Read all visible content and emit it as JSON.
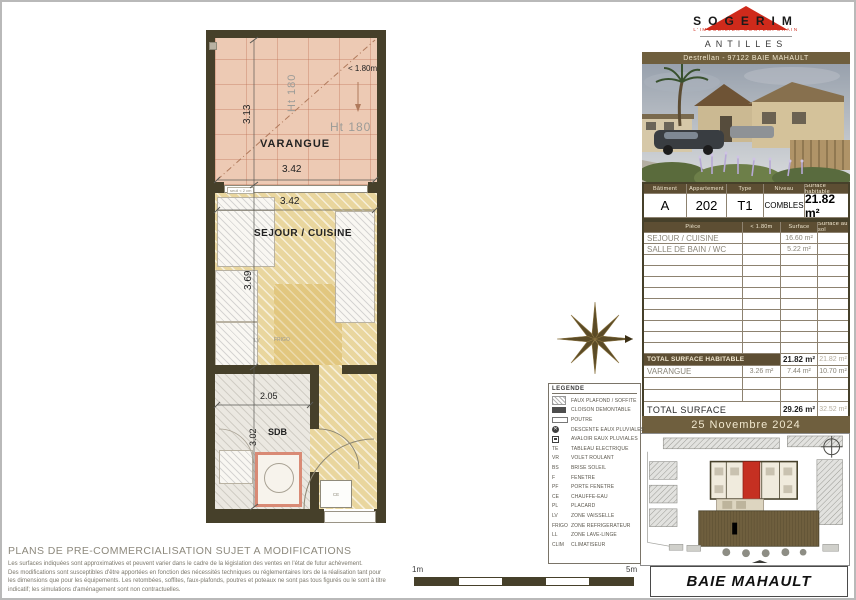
{
  "logo": {
    "company": "SOGERIM",
    "tagline": "L'IMMOBILIER CONTEMPORAIN",
    "region": "ANTILLES",
    "address": "Destrellan - 97122 BAIE MAHAULT"
  },
  "info_table": {
    "headers": [
      "Bâtiment",
      "Appartement",
      "Type",
      "Niveau",
      "Surface habitable"
    ],
    "values": {
      "batiment": "A",
      "appartement": "202",
      "type": "T1",
      "niveau": "COMBLES",
      "surface": "21.82 m²"
    }
  },
  "rooms_table": {
    "headers": [
      "Pièce",
      "< 1.80m",
      "Surface",
      "Surface au sol"
    ],
    "rows": [
      {
        "name": "SEJOUR / CUISINE",
        "lt180": "",
        "surface": "16.60 m²",
        "au_sol": ""
      },
      {
        "name": "SALLE DE BAIN / WC",
        "lt180": "",
        "surface": "5.22 m²",
        "au_sol": ""
      }
    ],
    "total_habitable": {
      "label": "TOTAL SURFACE HABITABLE",
      "surface": "21.82 m²",
      "au_sol": "21.82 m²"
    },
    "varangue_row": {
      "name": "VARANGUE",
      "lt180": "3.26 m²",
      "surface": "7.44 m²",
      "au_sol": "10.70 m²"
    },
    "total": {
      "label": "TOTAL SURFACE",
      "surface": "29.26 m²",
      "au_sol": "32.52 m²"
    }
  },
  "date": "25 Novembre 2024",
  "city": "BAIE MAHAULT",
  "plan": {
    "varangue": {
      "name": "VARANGUE",
      "width": "3.42",
      "height": "3.13",
      "ht1": "Ht 180",
      "ht2": "Ht 180",
      "low": "< 1.80m"
    },
    "sejour": {
      "name": "SEJOUR / CUISINE",
      "width": "3.42",
      "height": "3.69",
      "lv": "LV",
      "frigo": "FRIGO"
    },
    "sdb": {
      "name": "SDB",
      "width": "2.05",
      "height": "3.02",
      "ce": "CE"
    },
    "window_note": "seuil < 2 cm"
  },
  "legend": {
    "title": "LEGENDE",
    "items": [
      {
        "sym": "hatch",
        "label": "FAUX PLAFOND / SOFFITE"
      },
      {
        "sym": "dark",
        "label": "CLOISON DEMONTABLE"
      },
      {
        "sym": "outline",
        "label": "POUTRE"
      },
      {
        "sym": "circle",
        "label": "DESCENTE EAUX PLUVIALES"
      },
      {
        "sym": "square",
        "label": "AVALOIR EAUX PLUVIALES"
      },
      {
        "abbr": "TE",
        "label": "TABLEAU ELECTRIQUE"
      },
      {
        "abbr": "VR",
        "label": "VOLET ROULANT"
      },
      {
        "abbr": "BS",
        "label": "BRISE SOLEIL"
      },
      {
        "abbr": "F",
        "label": "FENETRE"
      },
      {
        "abbr": "PF",
        "label": "PORTE FENETRE"
      },
      {
        "abbr": "CE",
        "label": "CHAUFFE-EAU"
      },
      {
        "abbr": "PL",
        "label": "PLACARD"
      },
      {
        "abbr": "LV",
        "label": "ZONE VAISSELLE"
      },
      {
        "abbr": "FRIGO",
        "label": "ZONE REFRIGERATEUR"
      },
      {
        "abbr": "LL",
        "label": "ZONE LAVE-LINGE"
      },
      {
        "abbr": "CLIM",
        "label": "CLIMATISEUR"
      }
    ]
  },
  "disclaimer": {
    "title": "PLANS DE PRE-COMMERCIALISATION SUJET A MODIFICATIONS",
    "lines": [
      "Les surfaces indiquées sont approximatives et peuvent varier dans le cadre de la législation des ventes en l'état de futur achèvement.",
      "Des modifications sont susceptibles d'être apportées en fonction des nécessités techniques ou réglementaires lors de la réalisation tant pour",
      "les dimensions que pour les équipements. Les retombées, soffites, faux-plafonds, poutres et poteaux ne sont pas tous figurés ou le sont à titre",
      "indicatif; les simulations d'aménagement sont non contractuelles."
    ]
  },
  "scale": {
    "left": "1m",
    "right": "5m"
  },
  "colors": {
    "accent_red": "#cf2a1b",
    "brown": "#5d4e33",
    "wall": "#46402a",
    "unit_red": "#c53022"
  }
}
